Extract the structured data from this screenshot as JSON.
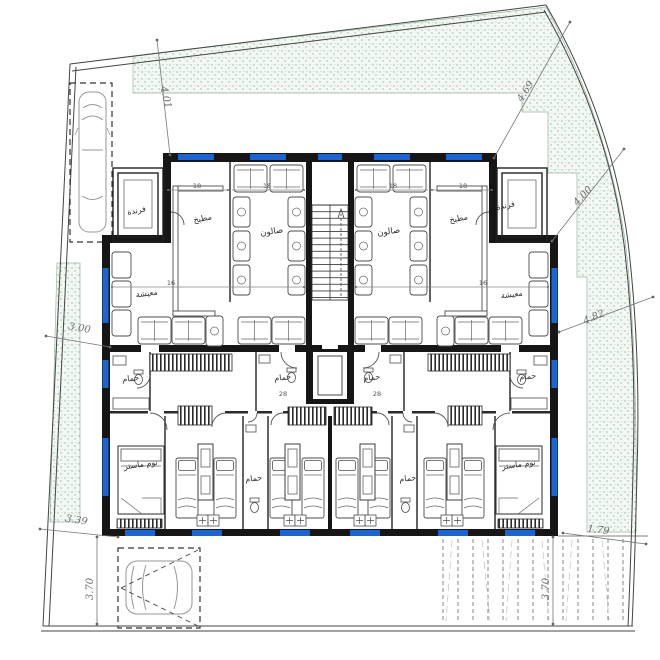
{
  "colors": {
    "window_blue": "#1b64d3",
    "wall": "#161616",
    "hatch_dot": "#8fb89f",
    "hatch_bg": "#f3f8f4",
    "dim_text": "#6e6e6e"
  },
  "site_dimensions": [
    {
      "id": "top-left-setback",
      "text": "4.01"
    },
    {
      "id": "top-right-setback",
      "text": "4.69"
    },
    {
      "id": "right-upper-setback",
      "text": "4.00"
    },
    {
      "id": "right-lower-setback",
      "text": "4.82"
    },
    {
      "id": "left-setback",
      "text": "3.00"
    },
    {
      "id": "bottom-left-setback",
      "text": "3.39"
    },
    {
      "id": "yard-depth-left",
      "text": "3.70"
    },
    {
      "id": "yard-depth-right",
      "text": "3.70"
    },
    {
      "id": "ramp-width",
      "text": "1.79"
    }
  ],
  "rooms": [
    {
      "id": "veranda-left",
      "label": "فرندة"
    },
    {
      "id": "kitchen-left",
      "label": "مطبخ"
    },
    {
      "id": "salon-left",
      "label": "صالون"
    },
    {
      "id": "living-left",
      "label": "معيشة"
    },
    {
      "id": "bath-upper-left",
      "label": "حمام"
    },
    {
      "id": "bath-inner-left",
      "label": "حمام"
    },
    {
      "id": "bath-lower-left",
      "label": "حمام"
    },
    {
      "id": "master-bed-left",
      "label": "نوم ماستر"
    },
    {
      "id": "veranda-right",
      "label": "فرندة"
    },
    {
      "id": "kitchen-right",
      "label": "مطبخ"
    },
    {
      "id": "salon-right",
      "label": "صالون"
    },
    {
      "id": "living-right",
      "label": "معيشة"
    },
    {
      "id": "bath-inner-right",
      "label": "حمام"
    },
    {
      "id": "bath-upper-right",
      "label": "حمام"
    },
    {
      "id": "bath-lower-right",
      "label": "حمام"
    },
    {
      "id": "master-bed-right",
      "label": "نوم ماستر"
    }
  ],
  "interior_dimensions": [
    {
      "text": "18"
    },
    {
      "text": "18"
    },
    {
      "text": "16"
    },
    {
      "text": "18"
    },
    {
      "text": "18"
    },
    {
      "text": "16"
    },
    {
      "text": "28"
    },
    {
      "text": "28"
    }
  ]
}
